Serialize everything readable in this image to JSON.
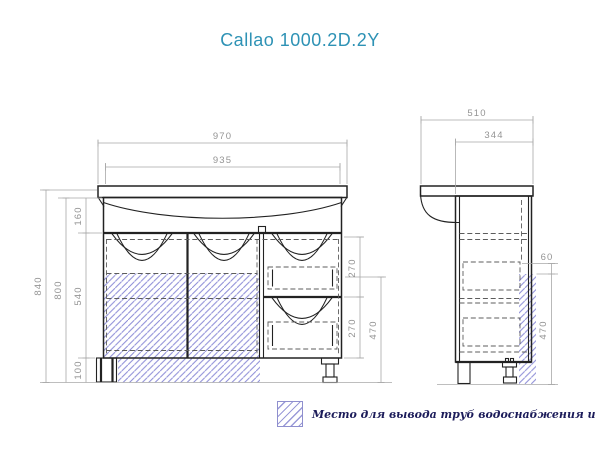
{
  "title": "Callao 1000.2D.2Y",
  "front_view": {
    "dims": {
      "overall_width": "970",
      "cabinet_width": "935",
      "overall_height": "840",
      "cabinet_height": "800",
      "basin_section_height": "160",
      "door_section_height": "540",
      "leg_height": "100",
      "top_drawer_height": "270",
      "bottom_drawer_height": "270",
      "pipe_zone_height": "470"
    }
  },
  "side_view": {
    "dims": {
      "overall_depth": "510",
      "cabinet_depth": "344",
      "pipe_zone_offset": "60",
      "pipe_zone_height": "470"
    }
  },
  "legend": {
    "label": "Место для вывода труб водоснабжения и канализации"
  },
  "colors": {
    "title": "#2e92b5",
    "hatch": "#8383d8",
    "line": "#222222",
    "dimension": "#9c9c9c",
    "legend_text": "#1c1c5a"
  }
}
